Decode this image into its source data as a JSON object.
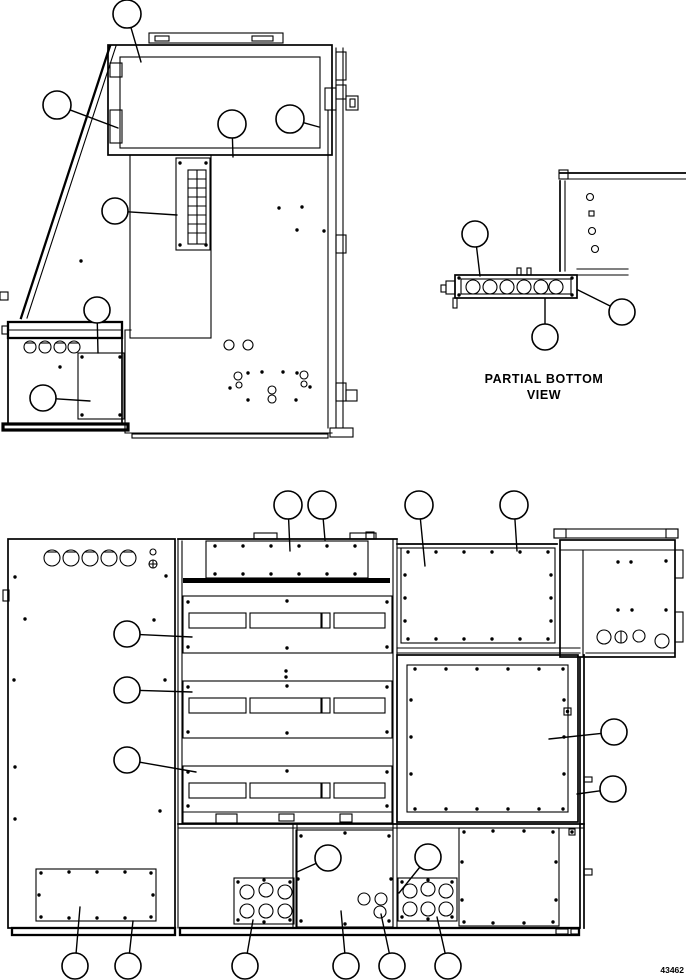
{
  "captions": {
    "partial_bottom_line1": "PARTIAL BOTTOM",
    "partial_bottom_line2": "VIEW",
    "figure_number": "43462"
  },
  "colors": {
    "line": "#000000",
    "background": "#ffffff"
  },
  "views": {
    "side_view": {
      "group": "side-view-callouts",
      "callouts": [
        {
          "cx": 127,
          "cy": 14,
          "r": 14,
          "tx": 141,
          "ty": 62,
          "label": ""
        },
        {
          "cx": 57,
          "cy": 105,
          "r": 14,
          "tx": 118,
          "ty": 128,
          "label": ""
        },
        {
          "cx": 232,
          "cy": 124,
          "r": 14,
          "tx": 233,
          "ty": 157,
          "label": ""
        },
        {
          "cx": 290,
          "cy": 119,
          "r": 14,
          "tx": 319,
          "ty": 127,
          "label": ""
        },
        {
          "cx": 115,
          "cy": 211,
          "r": 13,
          "tx": 177,
          "ty": 215,
          "label": ""
        },
        {
          "cx": 97,
          "cy": 310,
          "r": 13,
          "tx": 98,
          "ty": 353,
          "label": ""
        },
        {
          "cx": 43,
          "cy": 398,
          "r": 13,
          "tx": 90,
          "ty": 401,
          "label": ""
        }
      ]
    },
    "partial_bottom_view": {
      "group": "partial-bottom-view-callouts",
      "callouts": [
        {
          "cx": 475,
          "cy": 234,
          "r": 13,
          "tx": 480,
          "ty": 276,
          "label": ""
        },
        {
          "cx": 545,
          "cy": 337,
          "r": 13,
          "tx": 545,
          "ty": 299,
          "label": ""
        },
        {
          "cx": 622,
          "cy": 312,
          "r": 13,
          "tx": 578,
          "ty": 290,
          "label": ""
        }
      ]
    },
    "rear_view": {
      "group": "rear-view-callouts",
      "callouts": [
        {
          "cx": 288,
          "cy": 505,
          "r": 14,
          "tx": 290,
          "ty": 551,
          "label": ""
        },
        {
          "cx": 322,
          "cy": 505,
          "r": 14,
          "tx": 325,
          "ty": 540,
          "label": ""
        },
        {
          "cx": 419,
          "cy": 505,
          "r": 14,
          "tx": 425,
          "ty": 566,
          "label": ""
        },
        {
          "cx": 514,
          "cy": 505,
          "r": 14,
          "tx": 517,
          "ty": 551,
          "label": ""
        },
        {
          "cx": 127,
          "cy": 634,
          "r": 13,
          "tx": 192,
          "ty": 637,
          "label": ""
        },
        {
          "cx": 127,
          "cy": 690,
          "r": 13,
          "tx": 192,
          "ty": 692,
          "label": ""
        },
        {
          "cx": 127,
          "cy": 760,
          "r": 13,
          "tx": 196,
          "ty": 772,
          "label": ""
        },
        {
          "cx": 614,
          "cy": 732,
          "r": 13,
          "tx": 549,
          "ty": 739,
          "label": ""
        },
        {
          "cx": 613,
          "cy": 789,
          "r": 13,
          "tx": 577,
          "ty": 794,
          "label": ""
        },
        {
          "cx": 328,
          "cy": 858,
          "r": 13,
          "tx": 297,
          "ty": 872,
          "label": ""
        },
        {
          "cx": 428,
          "cy": 857,
          "r": 13,
          "tx": 399,
          "ty": 893,
          "label": ""
        },
        {
          "cx": 75,
          "cy": 966,
          "r": 13,
          "tx": 80,
          "ty": 907,
          "label": ""
        },
        {
          "cx": 128,
          "cy": 966,
          "r": 13,
          "tx": 133,
          "ty": 921,
          "label": ""
        },
        {
          "cx": 245,
          "cy": 966,
          "r": 13,
          "tx": 253,
          "ty": 920,
          "label": ""
        },
        {
          "cx": 346,
          "cy": 966,
          "r": 13,
          "tx": 341,
          "ty": 911,
          "label": ""
        },
        {
          "cx": 392,
          "cy": 966,
          "r": 13,
          "tx": 381,
          "ty": 914,
          "label": ""
        },
        {
          "cx": 448,
          "cy": 966,
          "r": 13,
          "tx": 437,
          "ty": 917,
          "label": ""
        }
      ]
    }
  }
}
